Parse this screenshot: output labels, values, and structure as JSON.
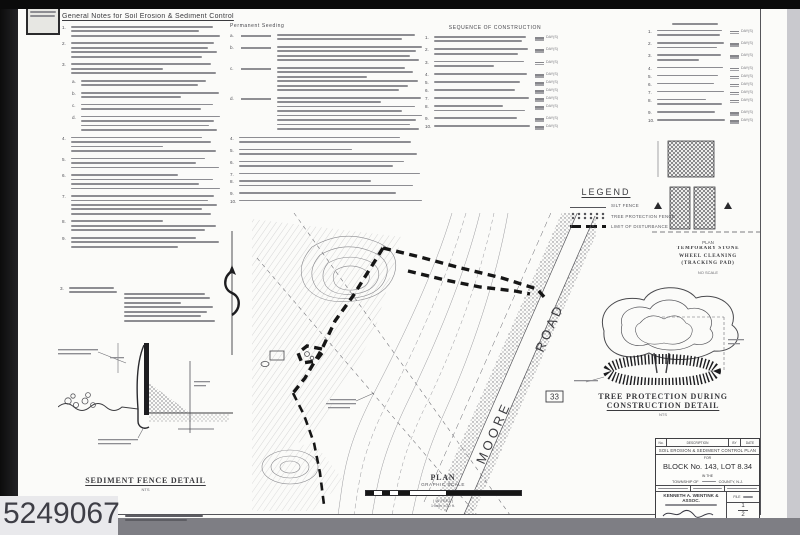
{
  "scan": {
    "stamp_number": "5249067"
  },
  "notes_left": {
    "title": "General  Notes  for  Soil  Erosion  &  Sediment  Control",
    "paras": [
      {
        "n": "1.",
        "lines": 3
      },
      {
        "n": "2.",
        "lines": 4
      },
      {
        "n": "3.",
        "lines": 3
      },
      {
        "n": "a.",
        "lines": 2,
        "ind": 1
      },
      {
        "n": "b.",
        "lines": 2,
        "ind": 1
      },
      {
        "n": "c.",
        "lines": 2,
        "ind": 1
      },
      {
        "n": "d.",
        "lines": 4,
        "ind": 1
      },
      {
        "n": "4.",
        "lines": 4
      },
      {
        "n": "5.",
        "lines": 3
      },
      {
        "n": "6.",
        "lines": 4
      },
      {
        "n": "7.",
        "lines": 5
      },
      {
        "n": "8.",
        "lines": 3
      },
      {
        "n": "9.",
        "lines": 3
      }
    ],
    "cont": {
      "n": "3.",
      "lines": 2
    }
  },
  "notes_mid": {
    "header": "Permanent Seeding",
    "rows": [
      {
        "n": "a.",
        "lines": 2,
        "bar": true
      },
      {
        "n": "b.",
        "lines": 4,
        "bar": true
      },
      {
        "n": "c.",
        "lines": 6,
        "bar": true
      },
      {
        "n": "d.",
        "lines": 8,
        "bar": true
      }
    ],
    "paras": [
      {
        "n": "4.",
        "lines": 2
      },
      {
        "n": "5.",
        "lines": 2
      },
      {
        "n": "6.",
        "lines": 2
      },
      {
        "n": "7.",
        "lines": 1
      },
      {
        "n": "8.",
        "lines": 2
      },
      {
        "n": "9.",
        "lines": 1
      },
      {
        "n": "10.",
        "lines": 1
      }
    ]
  },
  "sequence": {
    "title": "SEQUENCE OF CONSTRUCTION",
    "unit": "DAY(S)",
    "rows": [
      {
        "n": "1.",
        "lines": 2
      },
      {
        "n": "2.",
        "lines": 2
      },
      {
        "n": "3.",
        "lines": 2
      },
      {
        "n": "4.",
        "lines": 1
      },
      {
        "n": "5.",
        "lines": 1
      },
      {
        "n": "6.",
        "lines": 1
      },
      {
        "n": "7.",
        "lines": 1
      },
      {
        "n": "8.",
        "lines": 2
      },
      {
        "n": "9.",
        "lines": 1
      },
      {
        "n": "10.",
        "lines": 1
      }
    ]
  },
  "schedule_right": {
    "unit": "DAY(S)",
    "rows": [
      {
        "n": "1.",
        "lines": 2
      },
      {
        "n": "2.",
        "lines": 2
      },
      {
        "n": "3.",
        "lines": 2
      },
      {
        "n": "4.",
        "lines": 1
      },
      {
        "n": "5.",
        "lines": 1
      },
      {
        "n": "6.",
        "lines": 1
      },
      {
        "n": "7.",
        "lines": 1
      },
      {
        "n": "8.",
        "lines": 2
      },
      {
        "n": "9.",
        "lines": 1
      },
      {
        "n": "10.",
        "lines": 1
      }
    ]
  },
  "legend": {
    "title": "LEGEND",
    "entries": [
      {
        "label": "SILT FENCE"
      },
      {
        "label": "TREE PROTECTION FENCE"
      },
      {
        "label": "LIMIT OF DISTURBANCE"
      }
    ]
  },
  "stone_pad": {
    "plan_label": "PLAN",
    "caption": [
      "TEMPORARY STONE",
      "WHEEL CLEANING",
      "(TRACKING PAD)"
    ],
    "scale": "NO SCALE"
  },
  "tree_detail": {
    "caption1": "TREE PROTECTION DURING",
    "caption2": "CONSTRUCTION DETAIL",
    "scale": "NTS"
  },
  "sediment_detail": {
    "caption": "SEDIMENT  FENCE  DETAIL",
    "scale": "NTS"
  },
  "plan_view": {
    "label": "PLAN",
    "sub_label": "GRAPHIC SCALE",
    "in_feet": "( IN FEET )",
    "scale_note": "1 inch = 30 ft.",
    "road_name_upper": "ROAD",
    "road_name_lower": "MOORE",
    "route_badge": "33"
  },
  "title_block": {
    "rev": {
      "no": "No.",
      "description": "DESCRIPTION",
      "by": "BY",
      "date": "DATE"
    },
    "plan_title": "SOIL EROSION & SEDIMENT CONTROL PLAN",
    "for_word": "FOR",
    "block_lot": "BLOCK No. 143, LOT 8.34",
    "in_the": "IN THE",
    "township_prefix": "TOWNSHIP OF",
    "township_suffix": "COUNTY, N.J.",
    "firm": "KENNETH A. WENTINK & ASSOC.",
    "file_label": "FILE",
    "sheet_top": "1",
    "sheet_bottom": "2"
  }
}
